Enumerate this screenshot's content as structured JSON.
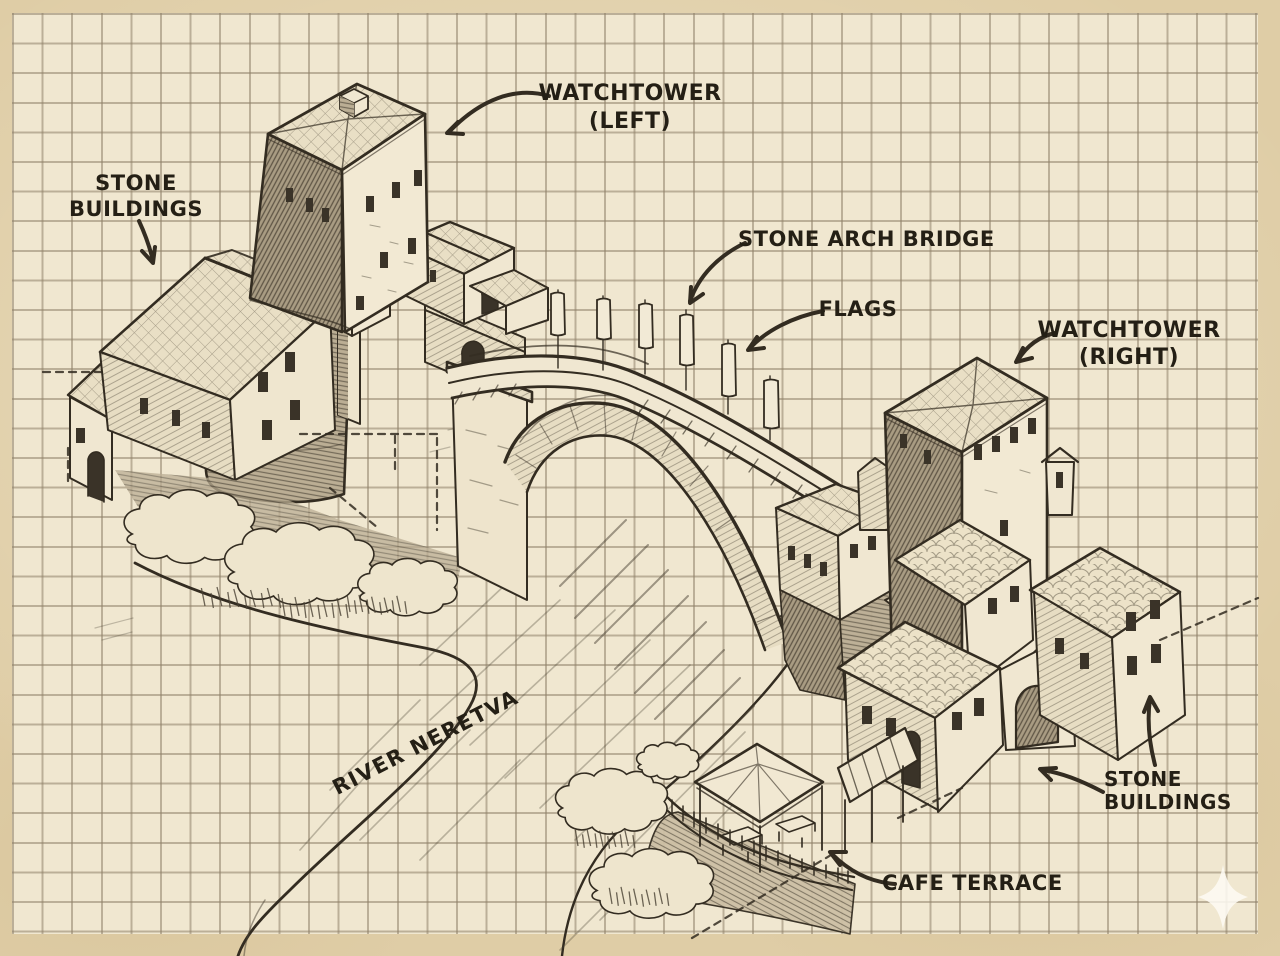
{
  "colors": {
    "margin": "#dfcda6",
    "paper": "#f0e7d0",
    "grid": "#8f8169",
    "ink": "#332c21",
    "label": "#241f15",
    "watermark": "#fdfaf2"
  },
  "annotations": {
    "watchtower_left": {
      "line1": "WATCHTOWER",
      "line2": "(LEFT)"
    },
    "stone_buildings_left": {
      "line1": "STONE",
      "line2": "BUILDINGS"
    },
    "stone_arch_bridge": {
      "text": "STONE ARCH BRIDGE"
    },
    "flags": {
      "text": "FLAGS"
    },
    "watchtower_right": {
      "line1": "WATCHTOWER",
      "line2": "(RIGHT)"
    },
    "river_neretva": {
      "text": "RIVER NERETVA"
    },
    "cafe_terrace": {
      "text": "CAFE TERRACE"
    },
    "stone_buildings_right": {
      "line1": "STONE",
      "line2": "BUILDINGS"
    }
  },
  "icons": {
    "watermark": "four-point-sparkle"
  }
}
